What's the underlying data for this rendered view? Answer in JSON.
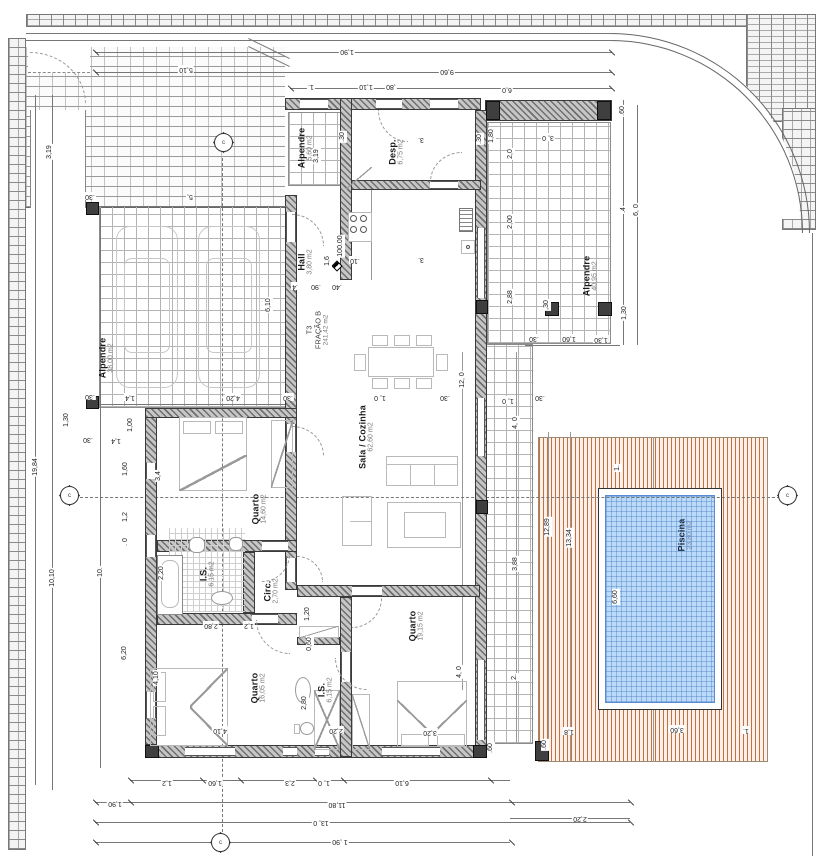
{
  "drawing": {
    "type": "architectural floor plan",
    "fraction": {
      "lines": [
        "T3",
        "FRAÇÃO B",
        "241,42 m2"
      ]
    },
    "level": {
      "value": "100.00"
    }
  },
  "rooms": [
    {
      "name": "Alpendre",
      "area": "38,00 m2",
      "x": 106,
      "y": 358
    },
    {
      "name": "Alpendre",
      "area": "5,60 m2",
      "x": 305,
      "y": 148
    },
    {
      "name": "Desp.",
      "area": "6,75 m2",
      "x": 396,
      "y": 152
    },
    {
      "name": "Hall",
      "area": "3,80 m2",
      "x": 305,
      "y": 262
    },
    {
      "name": "Sala / Cozinha",
      "area": "62,60 m2",
      "x": 366,
      "y": 437
    },
    {
      "name": "Quarto",
      "area": "14,60 m2",
      "x": 259,
      "y": 509
    },
    {
      "name": "I.S.",
      "area": "6,15 m2",
      "x": 207,
      "y": 574
    },
    {
      "name": "Circ.",
      "area": "2,70 m2",
      "x": 271,
      "y": 591
    },
    {
      "name": "Quarto",
      "area": "16,05 m2",
      "x": 258,
      "y": 688
    },
    {
      "name": "I.S.",
      "area": "6,15 m2",
      "x": 325,
      "y": 690
    },
    {
      "name": "Quarto",
      "area": "19,15 m2",
      "x": 416,
      "y": 626
    },
    {
      "name": "Alpendre",
      "area": "40,95 m2",
      "x": 590,
      "y": 276
    },
    {
      "name": "Piscina",
      "area": "23,80 m2",
      "x": 685,
      "y": 535,
      "cls": "pool"
    }
  ],
  "dims": [
    {
      "t": "1,90",
      "x": 347,
      "y": 51,
      "r": 180
    },
    {
      "t": "9,60",
      "x": 447,
      "y": 71,
      "r": 180
    },
    {
      "t": "1.",
      "x": 311,
      "y": 86,
      "r": 180
    },
    {
      "t": "1,10",
      "x": 366,
      "y": 86,
      "r": 180
    },
    {
      "t": ",80",
      "x": 391,
      "y": 86,
      "r": 180
    },
    {
      "t": "6,0",
      "x": 507,
      "y": 89,
      "r": 180
    },
    {
      "t": "5,10",
      "x": 186,
      "y": 69,
      "r": 180
    },
    {
      "t": ".30",
      "x": 90,
      "y": 196,
      "r": 180
    },
    {
      "t": "5,",
      "x": 190,
      "y": 196,
      "r": 180
    },
    {
      "t": "3,19",
      "x": 50,
      "y": 152,
      "r": -90
    },
    {
      "t": "19,84",
      "x": 36,
      "y": 467,
      "r": -90
    },
    {
      "t": "10,10",
      "x": 53,
      "y": 578,
      "r": -90
    },
    {
      "t": "10.",
      "x": 101,
      "y": 572,
      "r": -90
    },
    {
      "t": "1,30",
      "x": 67,
      "y": 420,
      "r": -90
    },
    {
      "t": ".30",
      "x": 88,
      "y": 439,
      "r": 180
    },
    {
      "t": "1,4",
      "x": 116,
      "y": 440,
      "r": 180
    },
    {
      "t": "1,00",
      "x": 131,
      "y": 425,
      "r": -90
    },
    {
      "t": "1,60",
      "x": 126,
      "y": 469,
      "r": -90
    },
    {
      "t": "3,4",
      "x": 159,
      "y": 476,
      "r": -90
    },
    {
      "t": "1,2",
      "x": 126,
      "y": 517,
      "r": -90
    },
    {
      "t": ". 0",
      "x": 126,
      "y": 542,
      "r": -90
    },
    {
      "t": "2,20",
      "x": 162,
      "y": 573,
      "r": -90
    },
    {
      "t": "6,20",
      "x": 125,
      "y": 653,
      "r": -90
    },
    {
      "t": "4,10",
      "x": 157,
      "y": 678,
      "r": -90
    },
    {
      "t": ".30",
      "x": 90,
      "y": 396,
      "r": 180
    },
    {
      "t": "1,4",
      "x": 130,
      "y": 397,
      "r": 180
    },
    {
      "t": "4,20",
      "x": 233,
      "y": 397,
      "r": 180
    },
    {
      "t": ".30",
      "x": 288,
      "y": 397,
      "r": 180
    },
    {
      "t": "3,19",
      "x": 317,
      "y": 156,
      "r": -90
    },
    {
      "t": ".4",
      "x": 295,
      "y": 286,
      "r": 180
    },
    {
      "t": ".90",
      "x": 316,
      "y": 286,
      "r": 180
    },
    {
      "t": ".40",
      "x": 337,
      "y": 286,
      "r": 180
    },
    {
      "t": ".30",
      "x": 343,
      "y": 137,
      "r": -90
    },
    {
      "t": "1,6",
      "x": 328,
      "y": 261,
      "r": -90
    },
    {
      "t": ".10",
      "x": 355,
      "y": 260,
      "r": 180
    },
    {
      "t": "3.",
      "x": 421,
      "y": 259,
      "r": 180
    },
    {
      "t": ".30",
      "x": 480,
      "y": 139,
      "r": -90
    },
    {
      "t": "1,80",
      "x": 492,
      "y": 136,
      "r": -90
    },
    {
      "t": "3.",
      "x": 421,
      "y": 139,
      "r": 180
    },
    {
      "t": "3, 0",
      "x": 548,
      "y": 137,
      "r": 180
    },
    {
      "t": "2,0",
      "x": 511,
      "y": 154,
      "r": -90
    },
    {
      "t": ".60",
      "x": 623,
      "y": 111,
      "r": -90
    },
    {
      "t": "2,00",
      "x": 511,
      "y": 222,
      "r": -90
    },
    {
      "t": "2,88",
      "x": 511,
      "y": 297,
      "r": -90
    },
    {
      "t": ".4",
      "x": 624,
      "y": 210,
      "r": -90
    },
    {
      "t": "6, 0",
      "x": 637,
      "y": 210,
      "r": -90
    },
    {
      "t": ",30",
      "x": 547,
      "y": 305,
      "r": -90
    },
    {
      "t": "1,30",
      "x": 625,
      "y": 313,
      "r": -90
    },
    {
      "t": ".30",
      "x": 534,
      "y": 338,
      "r": 180
    },
    {
      "t": "1,60",
      "x": 569,
      "y": 338,
      "r": 180
    },
    {
      "t": "1,30",
      "x": 601,
      "y": 339,
      "r": 180
    },
    {
      "t": "6,10",
      "x": 269,
      "y": 305,
      "r": -90
    },
    {
      "t": "12, 0",
      "x": 463,
      "y": 380,
      "r": -90
    },
    {
      "t": "1, 0",
      "x": 380,
      "y": 397,
      "r": 180
    },
    {
      "t": ".30",
      "x": 445,
      "y": 397,
      "r": 180
    },
    {
      "t": "1, 0",
      "x": 508,
      "y": 400,
      "r": 180
    },
    {
      "t": ".30",
      "x": 540,
      "y": 397,
      "r": 180
    },
    {
      "t": "4, 0",
      "x": 516,
      "y": 423,
      "r": -90
    },
    {
      "t": "3,88",
      "x": 516,
      "y": 564,
      "r": -90
    },
    {
      "t": "2.",
      "x": 515,
      "y": 677,
      "r": -90
    },
    {
      "t": "4, 0",
      "x": 460,
      "y": 672,
      "r": -90
    },
    {
      "t": "12,89",
      "x": 548,
      "y": 527,
      "r": -90
    },
    {
      "t": "13,34",
      "x": 570,
      "y": 538,
      "r": -90
    },
    {
      "t": "6,60",
      "x": 616,
      "y": 597,
      "r": -90
    },
    {
      "t": "1.",
      "x": 618,
      "y": 468,
      "r": -90
    },
    {
      "t": ".60",
      "x": 491,
      "y": 748,
      "r": -90
    },
    {
      "t": ".60",
      "x": 545,
      "y": 745,
      "r": -90
    },
    {
      "t": "1,8",
      "x": 569,
      "y": 731,
      "r": 180
    },
    {
      "t": "3,60",
      "x": 677,
      "y": 729,
      "r": 180
    },
    {
      "t": "1.",
      "x": 746,
      "y": 730,
      "r": 180
    },
    {
      "t": "1,2",
      "x": 167,
      "y": 782,
      "r": 180
    },
    {
      "t": "1,60",
      "x": 215,
      "y": 782,
      "r": 180
    },
    {
      "t": "2,3",
      "x": 290,
      "y": 782,
      "r": 180
    },
    {
      "t": "1, 0",
      "x": 324,
      "y": 782,
      "r": 180
    },
    {
      "t": "6,10",
      "x": 402,
      "y": 782,
      "r": 180
    },
    {
      "t": "1,90",
      "x": 115,
      "y": 803,
      "r": 180
    },
    {
      "t": "11,80",
      "x": 337,
      "y": 804,
      "r": 180
    },
    {
      "t": "2,20",
      "x": 580,
      "y": 818,
      "r": 180
    },
    {
      "t": "13, 0",
      "x": 321,
      "y": 822,
      "r": 180
    },
    {
      "t": "1 ,90",
      "x": 340,
      "y": 841,
      "r": 180
    },
    {
      "t": "4,10",
      "x": 220,
      "y": 730,
      "r": 180
    },
    {
      "t": "2,80",
      "x": 211,
      "y": 625,
      "r": 180
    },
    {
      "t": "1,2",
      "x": 249,
      "y": 625,
      "r": 180
    },
    {
      "t": "1,20",
      "x": 308,
      "y": 614,
      "r": -90
    },
    {
      "t": "0,60",
      "x": 310,
      "y": 644,
      "r": -90
    },
    {
      "t": "2,80",
      "x": 305,
      "y": 703,
      "r": -90
    },
    {
      "t": "2,20",
      "x": 336,
      "y": 730,
      "r": 180
    },
    {
      "t": "3,20",
      "x": 430,
      "y": 732,
      "r": 180
    }
  ],
  "datums": [
    {
      "x": 224,
      "y": 143,
      "l": "c"
    },
    {
      "x": 70,
      "y": 496,
      "l": "c"
    },
    {
      "x": 788,
      "y": 496,
      "l": "c"
    },
    {
      "x": 221,
      "y": 843,
      "l": "c"
    }
  ],
  "colors": {
    "wall_hatch": "#6f6f6f",
    "deck_stripe": "#c4713b",
    "pool_water": "#badaf8",
    "pool_line": "#5b8cd2",
    "dim_text": "#222222",
    "room_name_text": "#1a1a1a",
    "room_area_text": "#7a7a7a"
  }
}
